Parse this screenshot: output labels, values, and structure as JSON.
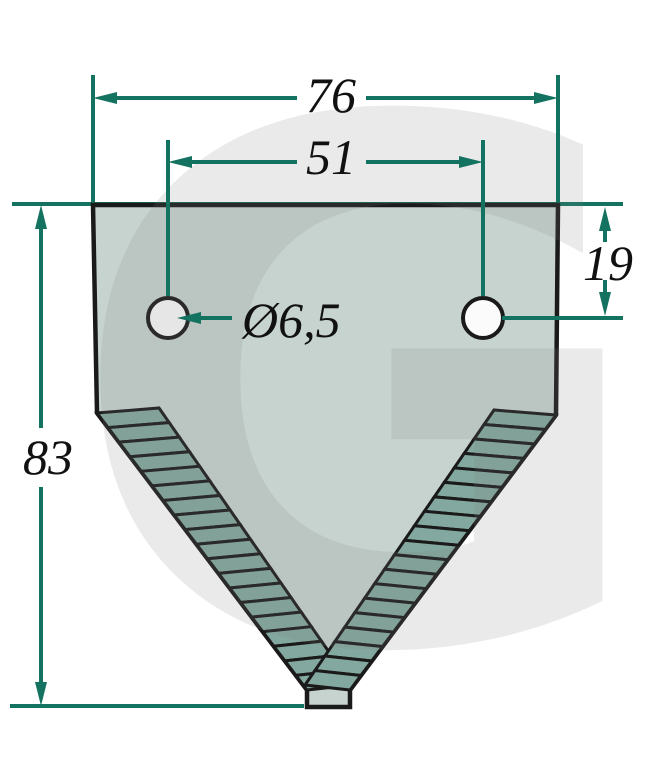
{
  "figure": {
    "type": "technical-drawing",
    "subject": "serrated mower knife section with two mounting holes",
    "watermark_letter": "G",
    "labels": {
      "overall_width": "76",
      "hole_spacing": "51",
      "hole_offset_from_top": "19",
      "overall_height": "83",
      "hole_diameter": "Ø6,5"
    },
    "colors": {
      "dimension_line": "#147360",
      "blade_fill": "#c7d3ce",
      "teeth_fill": "#83a89f",
      "outline": "#1a1a1a",
      "hole_fill": "#fbfbfb",
      "watermark": "#808080"
    }
  }
}
